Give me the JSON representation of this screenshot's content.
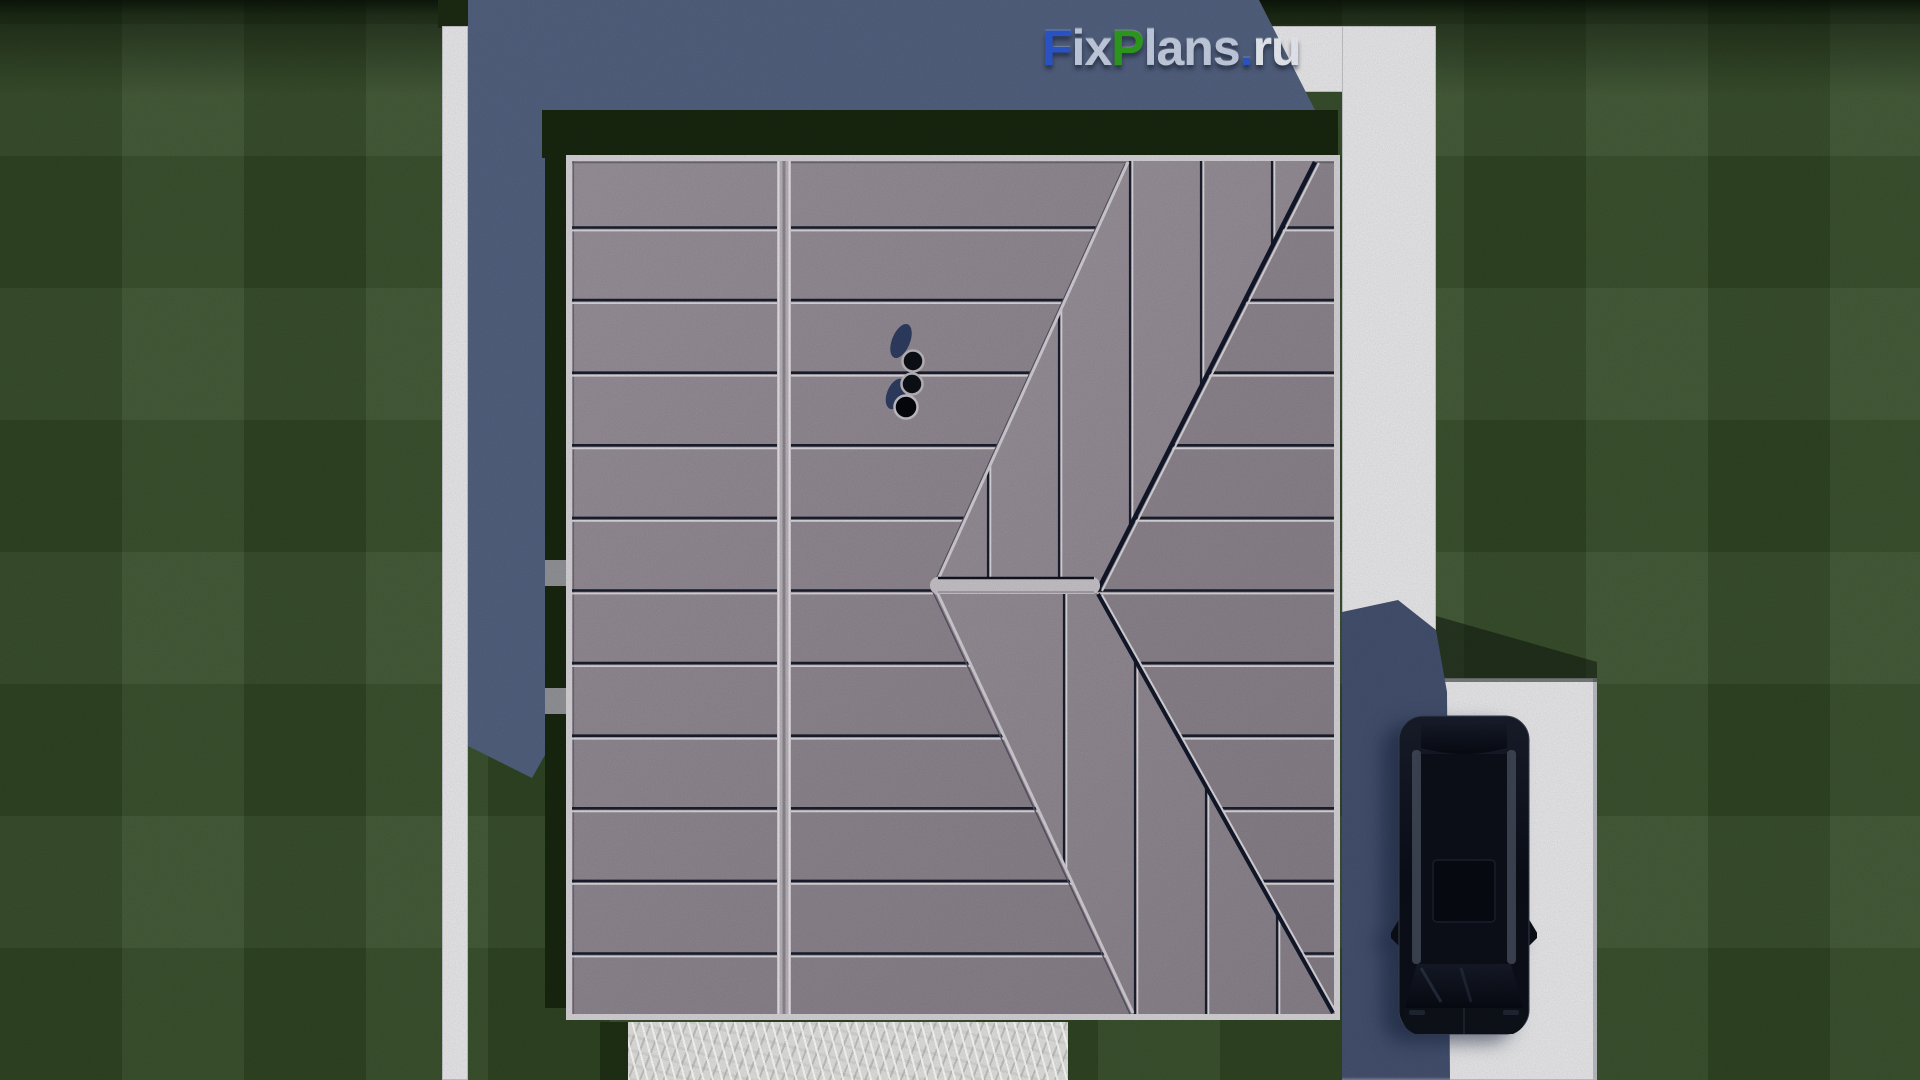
{
  "watermark": {
    "text": "FixPlans.ru",
    "parts": [
      {
        "text": "F",
        "color": "#2b58cf"
      },
      {
        "text": "ix",
        "color": "#c5cfe2"
      },
      {
        "text": "P",
        "color": "#2f9e1f"
      },
      {
        "text": "lans",
        "color": "#c5cfe2"
      },
      {
        "text": ".",
        "color": "#2b58cf"
      },
      {
        "text": "ru",
        "color": "#e9edf4"
      }
    ]
  },
  "watermark_strip": {
    "tiles": [
      {
        "color": "#dde3ee",
        "w": 16,
        "h": 9
      },
      {
        "color": "#dde3ee",
        "w": 16,
        "h": 9
      },
      {
        "color": "#dfe5f0",
        "w": 18,
        "h": 10
      },
      {
        "color": "#2456c8",
        "w": 13,
        "h": 11
      },
      {
        "color": "#dde3ee",
        "w": 16,
        "h": 10
      },
      {
        "color": "#e0e6f1",
        "w": 20,
        "h": 10
      },
      {
        "color": "#dde3ee",
        "w": 16,
        "h": 10
      },
      {
        "color": "#dfe5f0",
        "w": 20,
        "h": 11
      },
      {
        "color": "#dde3ee",
        "w": 14,
        "h": 10
      },
      {
        "color": "#2f9e1f",
        "w": 22,
        "h": 12
      },
      {
        "color": "#e2e8f2",
        "w": 24,
        "h": 12
      },
      {
        "color": "#dde3ee",
        "w": 16,
        "h": 11
      },
      {
        "color": "#2f9e1f",
        "w": 14,
        "h": 12
      },
      {
        "color": "#2456c8",
        "w": 30,
        "h": 20
      }
    ]
  },
  "palette": {
    "grass": "#344d27",
    "grassDark": "#1c2a13",
    "pavement": "#e8e8ea",
    "shadowBlue": "#51607e",
    "shadowDark": "#43506e",
    "roof": "#8e8690",
    "roofFascia": "#d4d2d6",
    "seamDark": "#191d2d",
    "seamLight": "#d9d7db",
    "ridgeLight": "#c6c2c8",
    "valleyDark": "#12172a",
    "hedge": "#18260f",
    "gravel": "#e0e0de",
    "carBody": "#0b0e18"
  },
  "scene": {
    "description": "Aerial top-down 3D render of a house: large gray standing-seam hip roof with three vent pipes, white concrete paths around a lawn, gravel strip at bottom, dark SUV parked on white driveway at right, building shadow cast to upper left",
    "roof_seam_spacing_px": 72.6,
    "roof_seam_first_y": 227.5,
    "roof_horizontal_seam_count": 11,
    "band_upper_seam_x": [
      988,
      1059,
      1130,
      1201,
      1272
    ],
    "band_lower_seam_x": [
      1064,
      1135,
      1206,
      1277
    ]
  }
}
